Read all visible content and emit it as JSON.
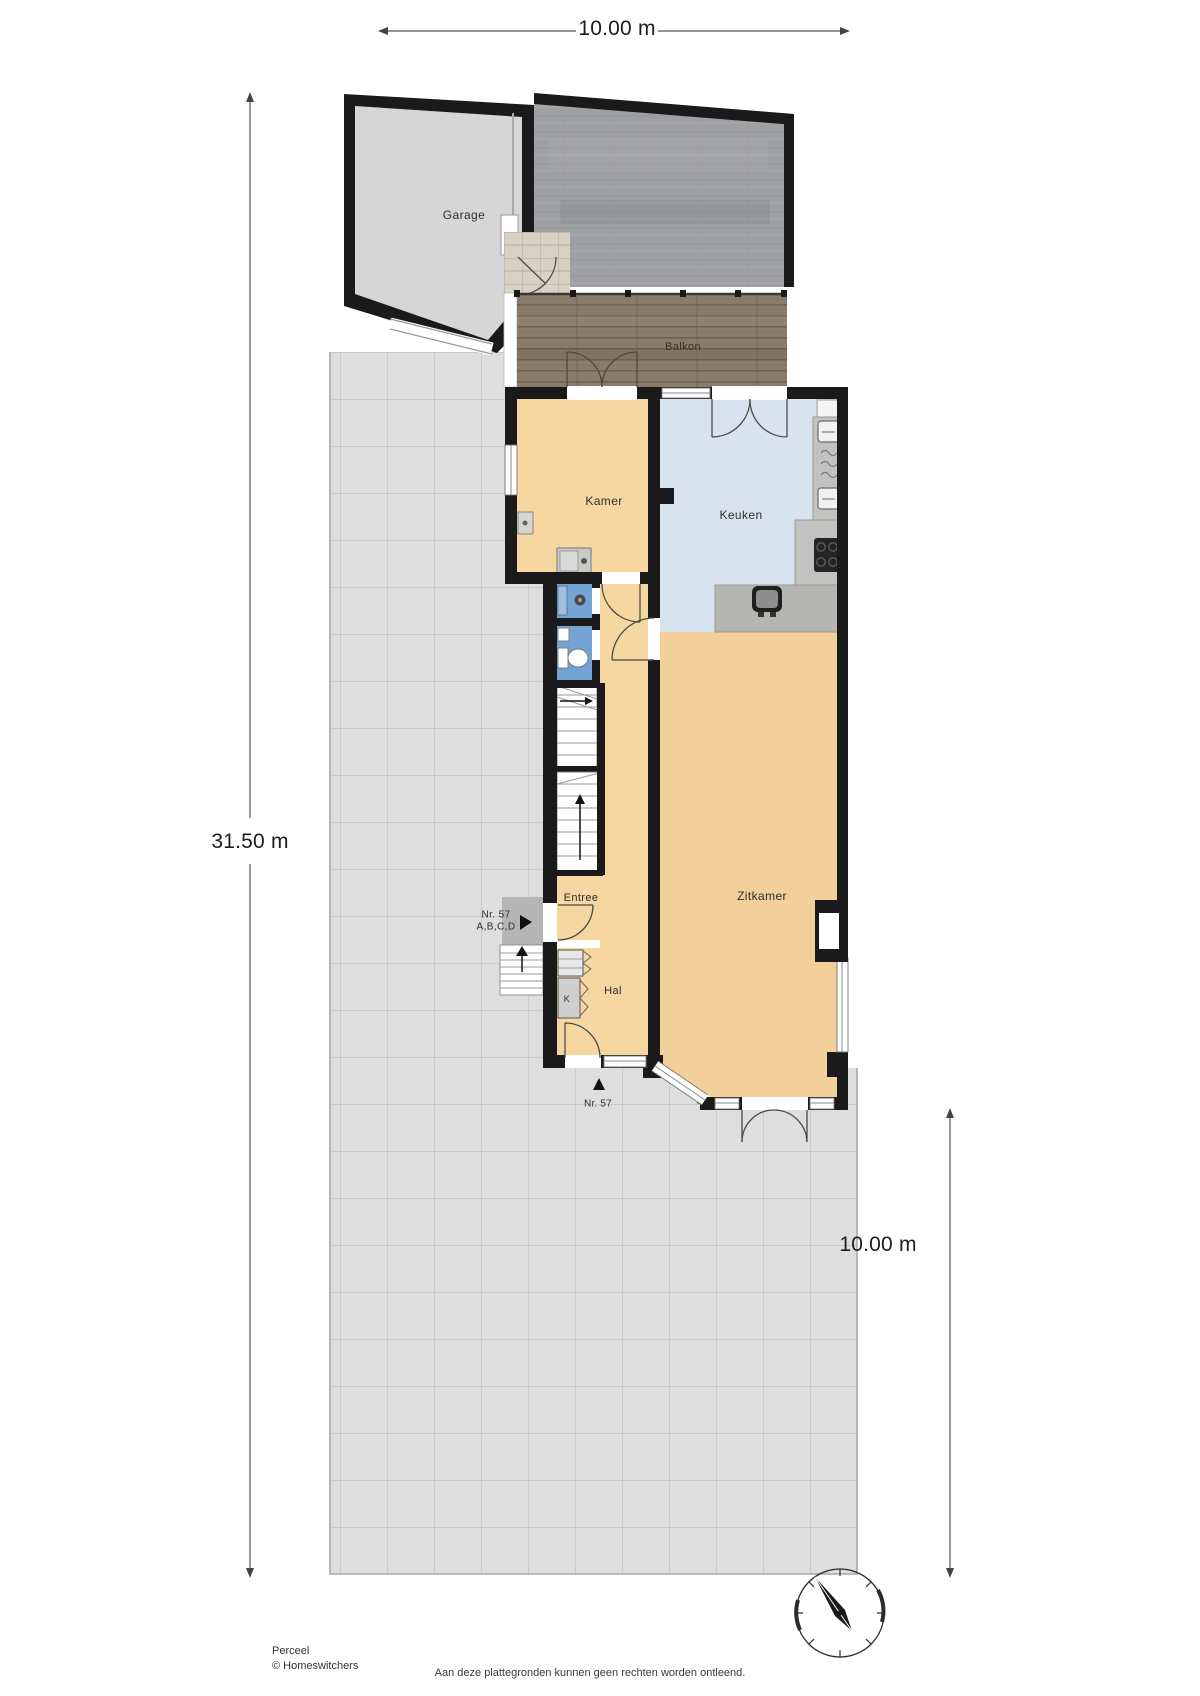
{
  "dimensions": {
    "top_width": "10.00 m",
    "left_height": "31.50 m",
    "right_width": "10.00 m"
  },
  "rooms": {
    "garage": "Garage",
    "balkon": "Balkon",
    "kamer": "Kamer",
    "keuken": "Keuken",
    "zitkamer": "Zitkamer",
    "entree": "Entree",
    "hal": "Hal",
    "closet_k": "K"
  },
  "markers": {
    "entrance_top": {
      "line1": "Nr. 57",
      "line2": "A,B,C,D"
    },
    "entrance_bottom": "Nr. 57"
  },
  "footer": {
    "plan_label": "Perceel",
    "copyright": "© Homeswitchers",
    "disclaimer": "Aan deze plattegronden kunnen geen rechten worden ontleend."
  },
  "icons": {
    "compass": "compass-rose",
    "entrance_marker": "triangle-right",
    "front_door_marker": "triangle-up"
  },
  "colors": {
    "wall": "#1a1a1a",
    "floor_living": "#f2cf9b",
    "floor_room": "#f6d7a2",
    "floor_kitchen": "#d7e4f0",
    "floor_bath": "#74a3d6",
    "terrace_tile": "#dedede",
    "balcony_wood": "#8b7b6a",
    "concrete_roof": "#9fa0a3",
    "counter": "#c2c2c0"
  }
}
